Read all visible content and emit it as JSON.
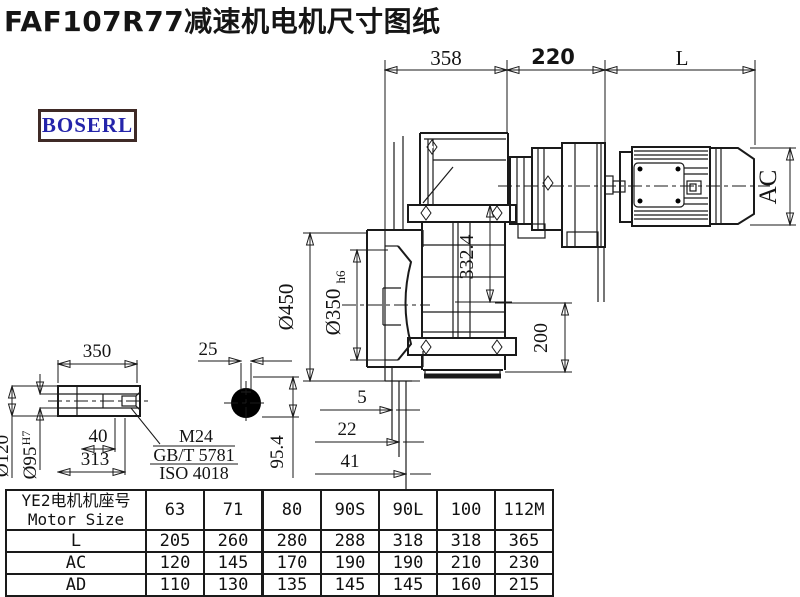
{
  "title": "FAF107R77减速机电机尺寸图纸",
  "logo": {
    "text": "BOSERL",
    "border_color": "#3f2a26",
    "text_color": "#2424aa"
  },
  "colors": {
    "line": "#1a1a1a",
    "background": "#ffffff"
  },
  "main_view": {
    "dim_overall_width": "358",
    "dim_motor_flange": "220",
    "dim_motor_len": "L",
    "dim_motor_diameter": "AC",
    "dim_flange_outer": "Ø450",
    "dim_spigot": "Ø350",
    "dim_spigot_tol": "h6",
    "dim_center_height": "332.4",
    "dim_foot": "200",
    "dim_step1": "5",
    "dim_step2": "22",
    "dim_step3": "41"
  },
  "shaft_view": {
    "dim_length": "350",
    "dim_hole_depth": "40",
    "dim_shaft_len": "313",
    "dim_outer": "Ø120",
    "dim_bore": "Ø95",
    "dim_bore_tol": "H7",
    "thread_spec": "M24",
    "thread_standard": "GB/T 5781",
    "thread_iso": "ISO 4018",
    "dim_key_width": "25",
    "dim_key_height": "95.4"
  },
  "table": {
    "header_line1": "YE2电机机座号",
    "header_line2": "Motor Size",
    "sizes": [
      "63",
      "71",
      "80",
      "90S",
      "90L",
      "100",
      "112M"
    ],
    "rows": [
      {
        "label": "L",
        "values": [
          "205",
          "260",
          "280",
          "288",
          "318",
          "318",
          "365"
        ]
      },
      {
        "label": "AC",
        "values": [
          "120",
          "145",
          "170",
          "190",
          "190",
          "210",
          "230"
        ]
      },
      {
        "label": "AD",
        "values": [
          "110",
          "130",
          "135",
          "145",
          "145",
          "160",
          "215"
        ]
      }
    ]
  }
}
